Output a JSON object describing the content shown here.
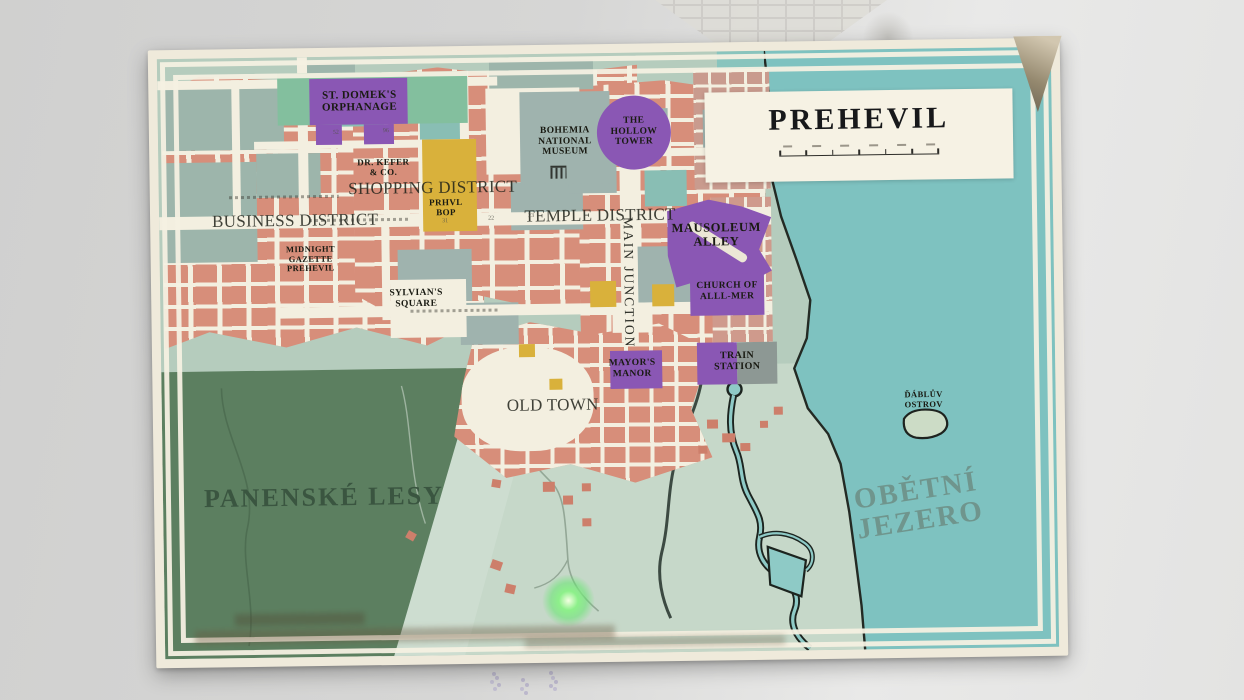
{
  "map": {
    "title": "PREHEVIL",
    "scale_bar": {
      "tick_count": 7,
      "label_count": 6
    },
    "districts": {
      "shopping": "SHOPPING DISTRICT",
      "business": "BUSINESS DISTRICT",
      "temple": "TEMPLE DISTRICT",
      "old_town": "OLD TOWN",
      "main_junction": "MAIN JUNCTION"
    },
    "landmarks": {
      "orphanage": "ST. DOMEK'S\nORPHANAGE",
      "museum": "BOHEMIA\nNATIONAL\nMUSEUM",
      "hollow_tower": "THE\nHOLLOW\nTOWER",
      "dr_kefer": "DR. KEFER\n& CO.",
      "prhvl_bop": "PRHVL\nBOP",
      "mausoleum_alley": "MAUSOLEUM\nALLEY",
      "midnight_gazette": "MIDNIGHT\nGAZETTE\nPREHEVIL",
      "sylvians_square": "SYLVIAN'S\nSQUARE",
      "church_alllmer": "CHURCH OF\nALLL-MER",
      "mayors_manor": "MAYOR'S\nMANOR",
      "train_station": "TRAIN\nSTATION"
    },
    "regions": {
      "forest": "PANENSKÉ LESY",
      "lake": "OBĚTNÍ\nJEZERO",
      "island": "ĎÁBLŮV\nOSTROV"
    },
    "street_numbers": [
      "52",
      "96",
      "31",
      "22",
      "23"
    ],
    "colors": {
      "building_salmon": "#d78e7a",
      "street_cream": "#f3efe0",
      "lake_teal": "#7ec2c0",
      "forest_green": "#5c7f60",
      "landmark_purple": "#8a57b4",
      "landmark_yellow": "#d9b13b",
      "city_base": "#b5ccbd",
      "player_glow": "#86f17f"
    }
  }
}
